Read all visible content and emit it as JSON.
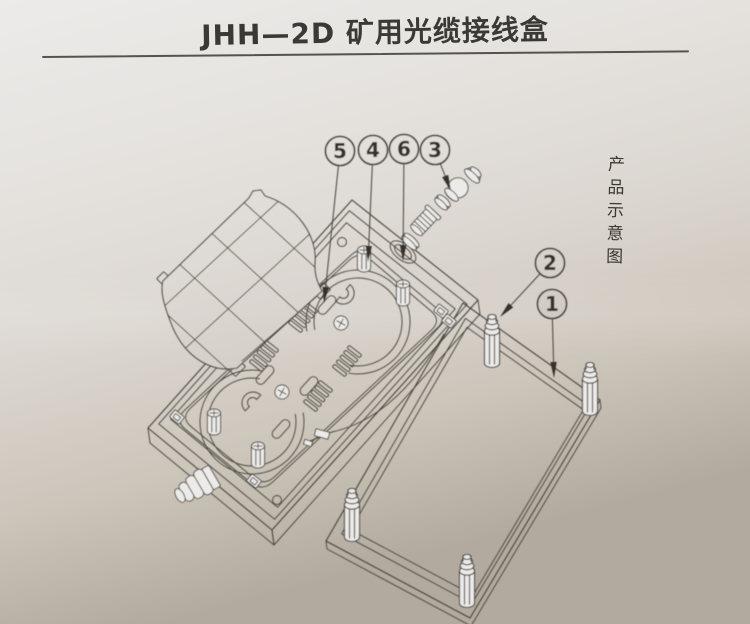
{
  "page": {
    "title": "JHH—2D 矿用光缆接线盒",
    "side_caption": "产品示意图"
  },
  "diagram": {
    "callouts": [
      {
        "number": "1",
        "cx": 552,
        "cy": 304,
        "tip": [
          554,
          378
        ]
      },
      {
        "number": "2",
        "cx": 550,
        "cy": 263,
        "tip": [
          500,
          317
        ]
      },
      {
        "number": "3",
        "cx": 435,
        "cy": 150,
        "tip": [
          451,
          191
        ]
      },
      {
        "number": "4",
        "cx": 373,
        "cy": 150,
        "tip": [
          368,
          262
        ]
      },
      {
        "number": "5",
        "cx": 340,
        "cy": 151,
        "tip": [
          324,
          303
        ]
      },
      {
        "number": "6",
        "cx": 404,
        "cy": 149,
        "tip": [
          403,
          261
        ]
      }
    ]
  },
  "colors": {
    "ink": "#45433c",
    "arrow": "#34322c",
    "paper_top": "#ecebe9",
    "paper_bottom": "#b2aa9e"
  }
}
